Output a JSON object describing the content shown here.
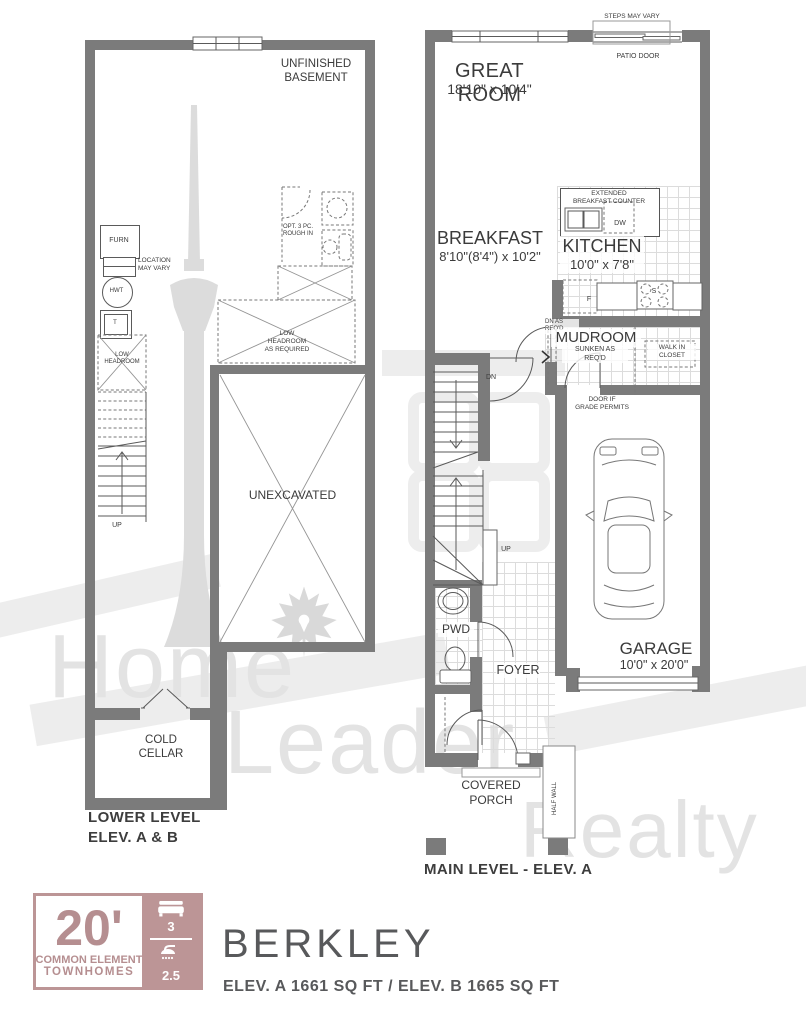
{
  "watermark": {
    "word1": "Home",
    "word2": "Leader",
    "word3": "Realty"
  },
  "lower_level": {
    "room_title": "UNFINISHED\nBASEMENT",
    "furnace_label": "FURN",
    "furnace_note": "LOCATION\nMAY VARY",
    "hwt_label": "HWT",
    "tank_label": "T",
    "low_headroom": "LOW\nHEADROOM",
    "rough_in": "OPT. 3 PC.\nROUGH IN",
    "low_headroom_required": "LOW\nHEADROOM\nAS REQUIRED",
    "unexcavated": "UNEXCAVATED",
    "up_label": "UP",
    "cold_cellar": "COLD\nCELLAR",
    "caption": "LOWER LEVEL\nELEV. A & B"
  },
  "main_level": {
    "steps_note": "STEPS MAY VARY",
    "patio_door": "PATIO DOOR",
    "great_room_name": "GREAT ROOM",
    "great_room_dims": "18'10\" x 10'4\"",
    "breakfast_name": "BREAKFAST",
    "breakfast_dims": "8'10\"(8'4\") x 10'2\"",
    "kitchen_name": "KITCHEN",
    "kitchen_dims": "10'0\" x 7'8\"",
    "counter_label": "EXTENDED\nBREAKFAST COUNTER",
    "dishwasher": "DW",
    "fridge": "F",
    "stove": "S",
    "dn_note": "DN AS\nREQ'D",
    "dn_label": "DN",
    "up_label": "UP",
    "mudroom_name": "MUDROOM",
    "mudroom_note": "SUNKEN AS\nREQ'D",
    "walk_in_closet": "WALK IN\nCLOSET",
    "grade_door_note": "DOOR IF\nGRADE PERMITS",
    "pwd": "PWD",
    "foyer": "FOYER",
    "garage_name": "GARAGE",
    "garage_dims": "10'0\" x 20'0\"",
    "porch": "COVERED\nPORCH",
    "half_wall": "HALF WALL",
    "caption": "MAIN LEVEL - ELEV. A"
  },
  "footer": {
    "logo_size": "20'",
    "logo_line1": "COMMON ELEMENT",
    "logo_line2": "TOWNHOMES",
    "beds": "3",
    "baths": "2.5",
    "model_name": "BERKLEY",
    "model_specs": "ELEV. A 1661 SQ FT / ELEV. B 1665 SQ FT",
    "accent_color": "#bc9596"
  }
}
